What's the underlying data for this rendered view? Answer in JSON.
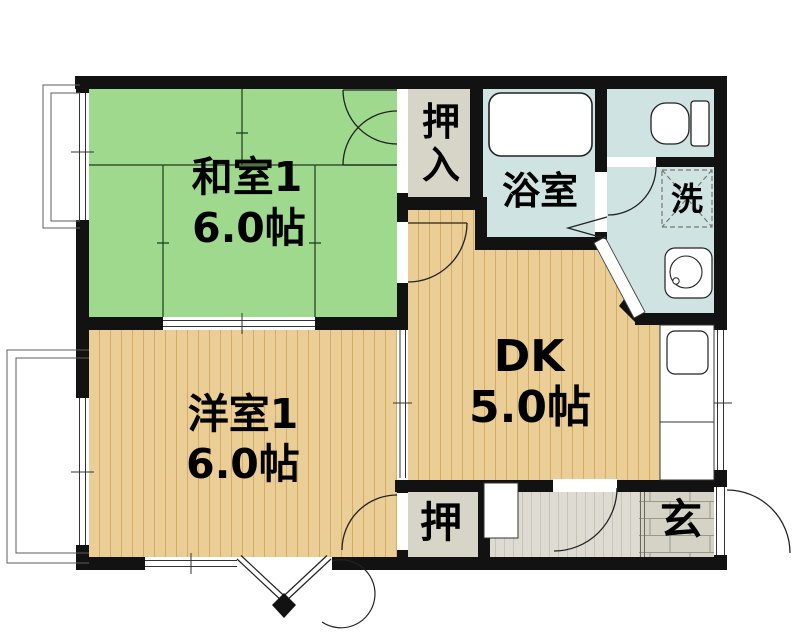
{
  "plan": {
    "type": "apartment-floor-plan",
    "rooms": {
      "washitsu": {
        "name": "和室1",
        "size": "6.0帖"
      },
      "youshitsu": {
        "name": "洋室1",
        "size": "6.0帖"
      },
      "dk": {
        "name": "DK",
        "size": "5.0帖"
      },
      "bathroom": {
        "name": "浴室"
      },
      "oshiire": {
        "char1": "押",
        "char2": "入"
      },
      "closet": {
        "name": "押"
      },
      "laundry": {
        "name": "洗"
      },
      "genkan": {
        "name": "玄"
      }
    },
    "colors": {
      "wall": "#121212",
      "tatami_green": "#9ed98d",
      "wood_floor": "#ebcd96",
      "wood_line": "#d3ac6a",
      "wet_area_blue": "#cfe4e2",
      "closet_grey": "#d7d5c7",
      "hallway_grey": "#dedcd2",
      "hallway_line": "#c6c4b6",
      "genkan_tile": "#d5d3c5",
      "genkan_line": "#9a988c",
      "fixture_white": "#ffffff"
    }
  }
}
